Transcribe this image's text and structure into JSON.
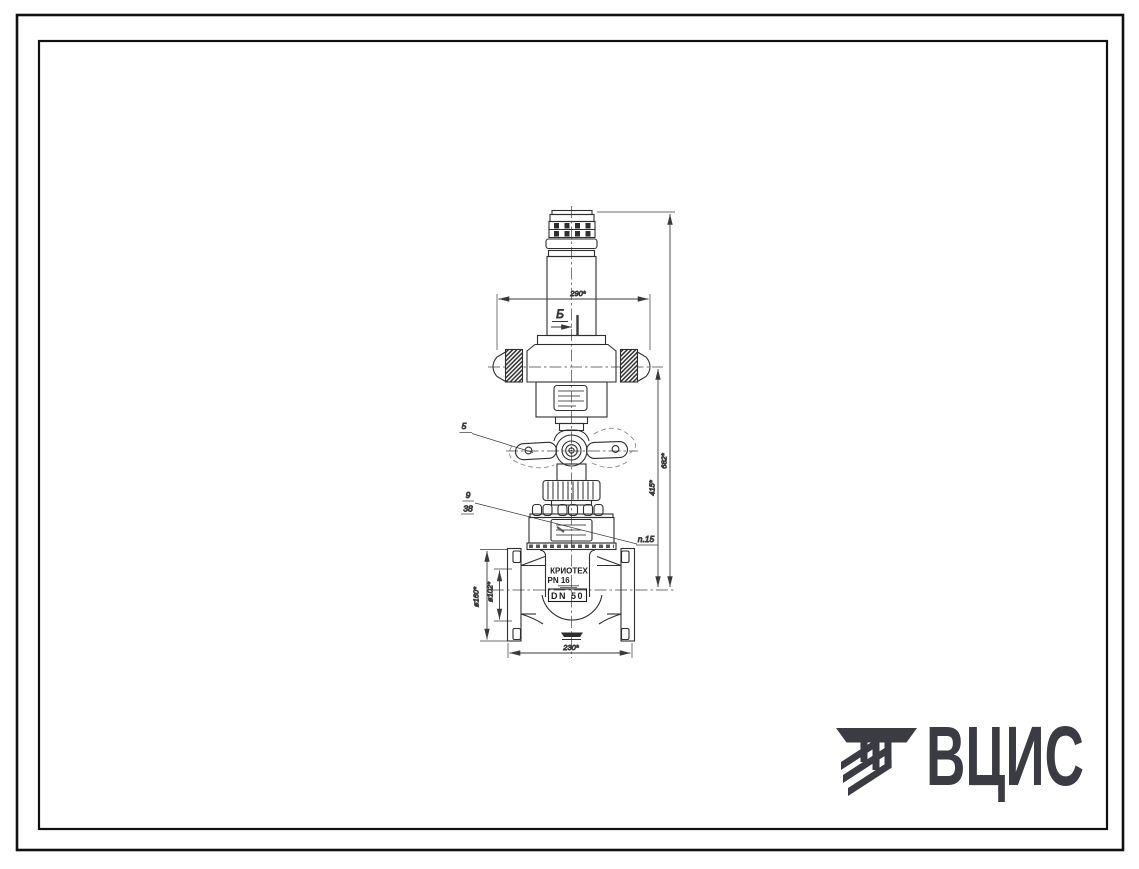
{
  "drawing": {
    "dims": {
      "width_top": "290*",
      "height_total": "682*",
      "height_mid": "415*",
      "flange_od": "ø160*",
      "raised_face": "ø102*",
      "flange_span": "230*"
    },
    "section_marker": "Б",
    "callouts": {
      "handle": "5",
      "item9": "9",
      "item38": "38",
      "item15": "n.15"
    },
    "body_markings": {
      "brand": "КРИОТЕХ",
      "pn": "PN 16",
      "dn": "DN 50"
    }
  },
  "logo": {
    "text": "ВЦИС"
  },
  "colors": {
    "ink": "#2e2e2e",
    "dim": "#3a3a3a",
    "logo": "#3b3b43",
    "frame": "#111111",
    "paper": "#ffffff"
  }
}
